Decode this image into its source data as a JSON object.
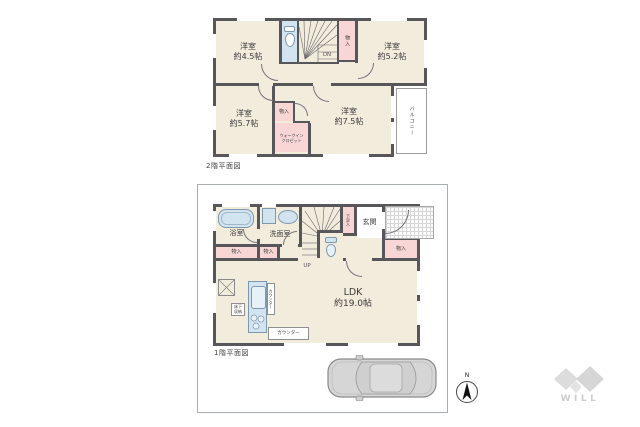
{
  "colors": {
    "floor": "#f2ecdc",
    "wall": "#57565b",
    "storage_pink": "#f7d6d5",
    "fixture_blue": "#d3e4f1",
    "fixture_outline": "#7d97ad",
    "frame_border": "#a8adb2",
    "car_gray": "#d6d6d6",
    "logo_gray": "#d6d6d6"
  },
  "floor2": {
    "caption": "2階平面図",
    "stairs_label": "DN",
    "rooms": {
      "room45": {
        "name": "洋室",
        "size": "約4.5帖"
      },
      "room52": {
        "name": "洋室",
        "size": "約5.2帖"
      },
      "room57": {
        "name": "洋室",
        "size": "約5.7帖"
      },
      "room75": {
        "name": "洋室",
        "size": "約7.5帖"
      },
      "storage_top": "物入",
      "storage_mid": "物入",
      "wic": {
        "line1": "ウォークイン",
        "line2": "クロゼット"
      },
      "balcony": "バルコニー"
    }
  },
  "floor1": {
    "caption": "1階平面図",
    "stairs_label": "UP",
    "rooms": {
      "bath": "浴室",
      "washroom": "洗面室",
      "storage_left_a": "物入",
      "storage_left_b": "物入",
      "storage_right": "物入",
      "shoe_cabinet": "下足入",
      "entrance": "玄関",
      "ldk": {
        "name": "LDK",
        "size": "約19.0帖"
      },
      "underfloor": {
        "line1": "床下",
        "line2": "収納"
      },
      "kitchen_counter": "カウンター",
      "dining_counter": "カウンター"
    }
  },
  "compass": {
    "north_label": "N"
  },
  "logo": {
    "text": "WILL"
  }
}
